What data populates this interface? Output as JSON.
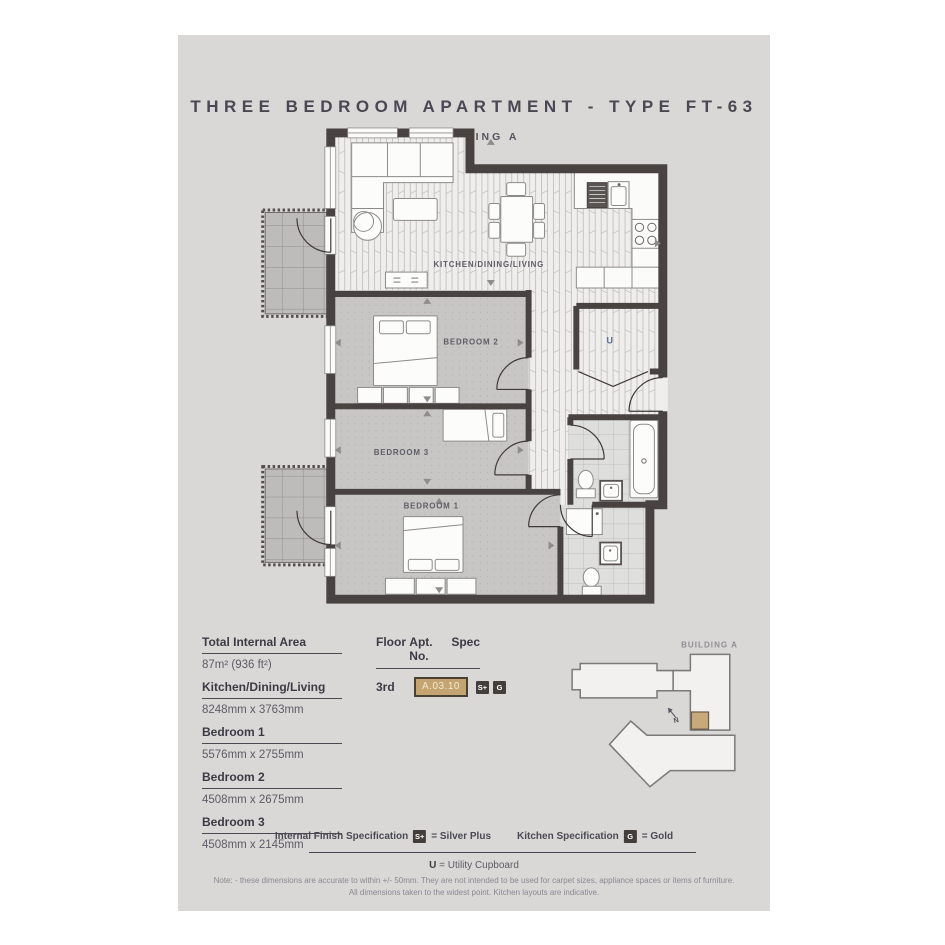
{
  "header": {
    "title": "THREE BEDROOM APARTMENT - TYPE FT-63",
    "subtitle": "BUILDING A"
  },
  "floorplan": {
    "labels": {
      "living": "KITCHEN/DINING/LIVING",
      "bedroom2": "BEDROOM 2",
      "bedroom3": "BEDROOM 3",
      "bedroom1": "BEDROOM 1",
      "utility": "U"
    }
  },
  "dimensions": [
    {
      "label": "Total Internal Area",
      "value": "87m² (936 ft²)"
    },
    {
      "label": "Kitchen/Dining/Living",
      "value": "8248mm x 3763mm"
    },
    {
      "label": "Bedroom 1",
      "value": "5576mm x 2755mm"
    },
    {
      "label": "Bedroom 2",
      "value": "4508mm x 2675mm"
    },
    {
      "label": "Bedroom 3",
      "value": "4508mm x 2145mm"
    }
  ],
  "unit": {
    "floor_header": "Floor",
    "apt_header": "Apt. No.",
    "spec_header": "Spec",
    "floor": "3rd",
    "apt_no": "A.03.10",
    "spec1": "S+",
    "spec2": "G"
  },
  "keyplan": {
    "building_label": "BUILDING A",
    "compass": "N"
  },
  "legend": {
    "finish_label": "Internal Finish Specification",
    "finish_badge": "S+",
    "finish_value": "= Silver Plus",
    "kitchen_label": "Kitchen Specification",
    "kitchen_badge": "G",
    "kitchen_value": "= Gold",
    "utility_key": "U",
    "utility_value": " = Utility Cupboard"
  },
  "notes": {
    "line1": "Note: - these dimensions are accurate to within +/- 50mm. They are not intended to be used for carpet sizes, appliance spaces or items of furniture.",
    "line2": "All dimensions taken to the widest point. Kitchen layouts are indicative."
  },
  "colors": {
    "accent_tan": "#c4a470",
    "badge_dark": "#443e3a",
    "wall": "#484240",
    "card_bg": "#d9d8d6"
  }
}
